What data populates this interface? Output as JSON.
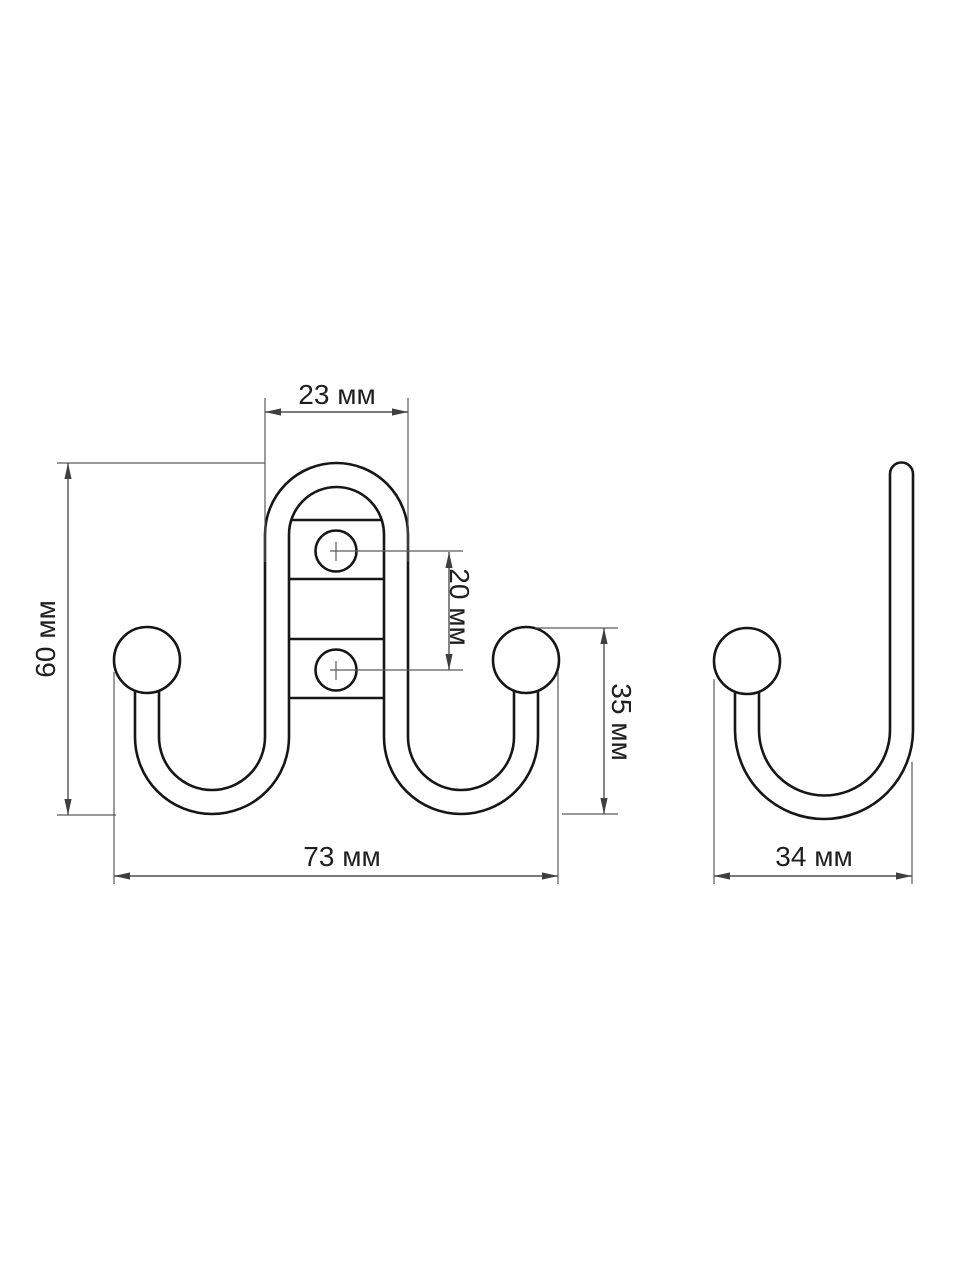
{
  "unit": "мм",
  "front_view": {
    "dim_top_width": "23 мм",
    "dim_height": "60 мм",
    "dim_hole_spacing": "20 мм",
    "dim_hook_height": "35 мм",
    "dim_total_width": "73 мм",
    "values_mm": {
      "top_width": 23,
      "height": 60,
      "hole_spacing": 20,
      "hook_height": 35,
      "total_width": 73
    },
    "hole_count": 2,
    "hook_count": 2
  },
  "side_view": {
    "dim_depth": "34 мм",
    "values_mm": {
      "depth": 34
    }
  },
  "colors": {
    "outline": "#161616",
    "dimension_lines": "#4f4f4f",
    "text": "#1f1f1f",
    "background": "#ffffff"
  }
}
